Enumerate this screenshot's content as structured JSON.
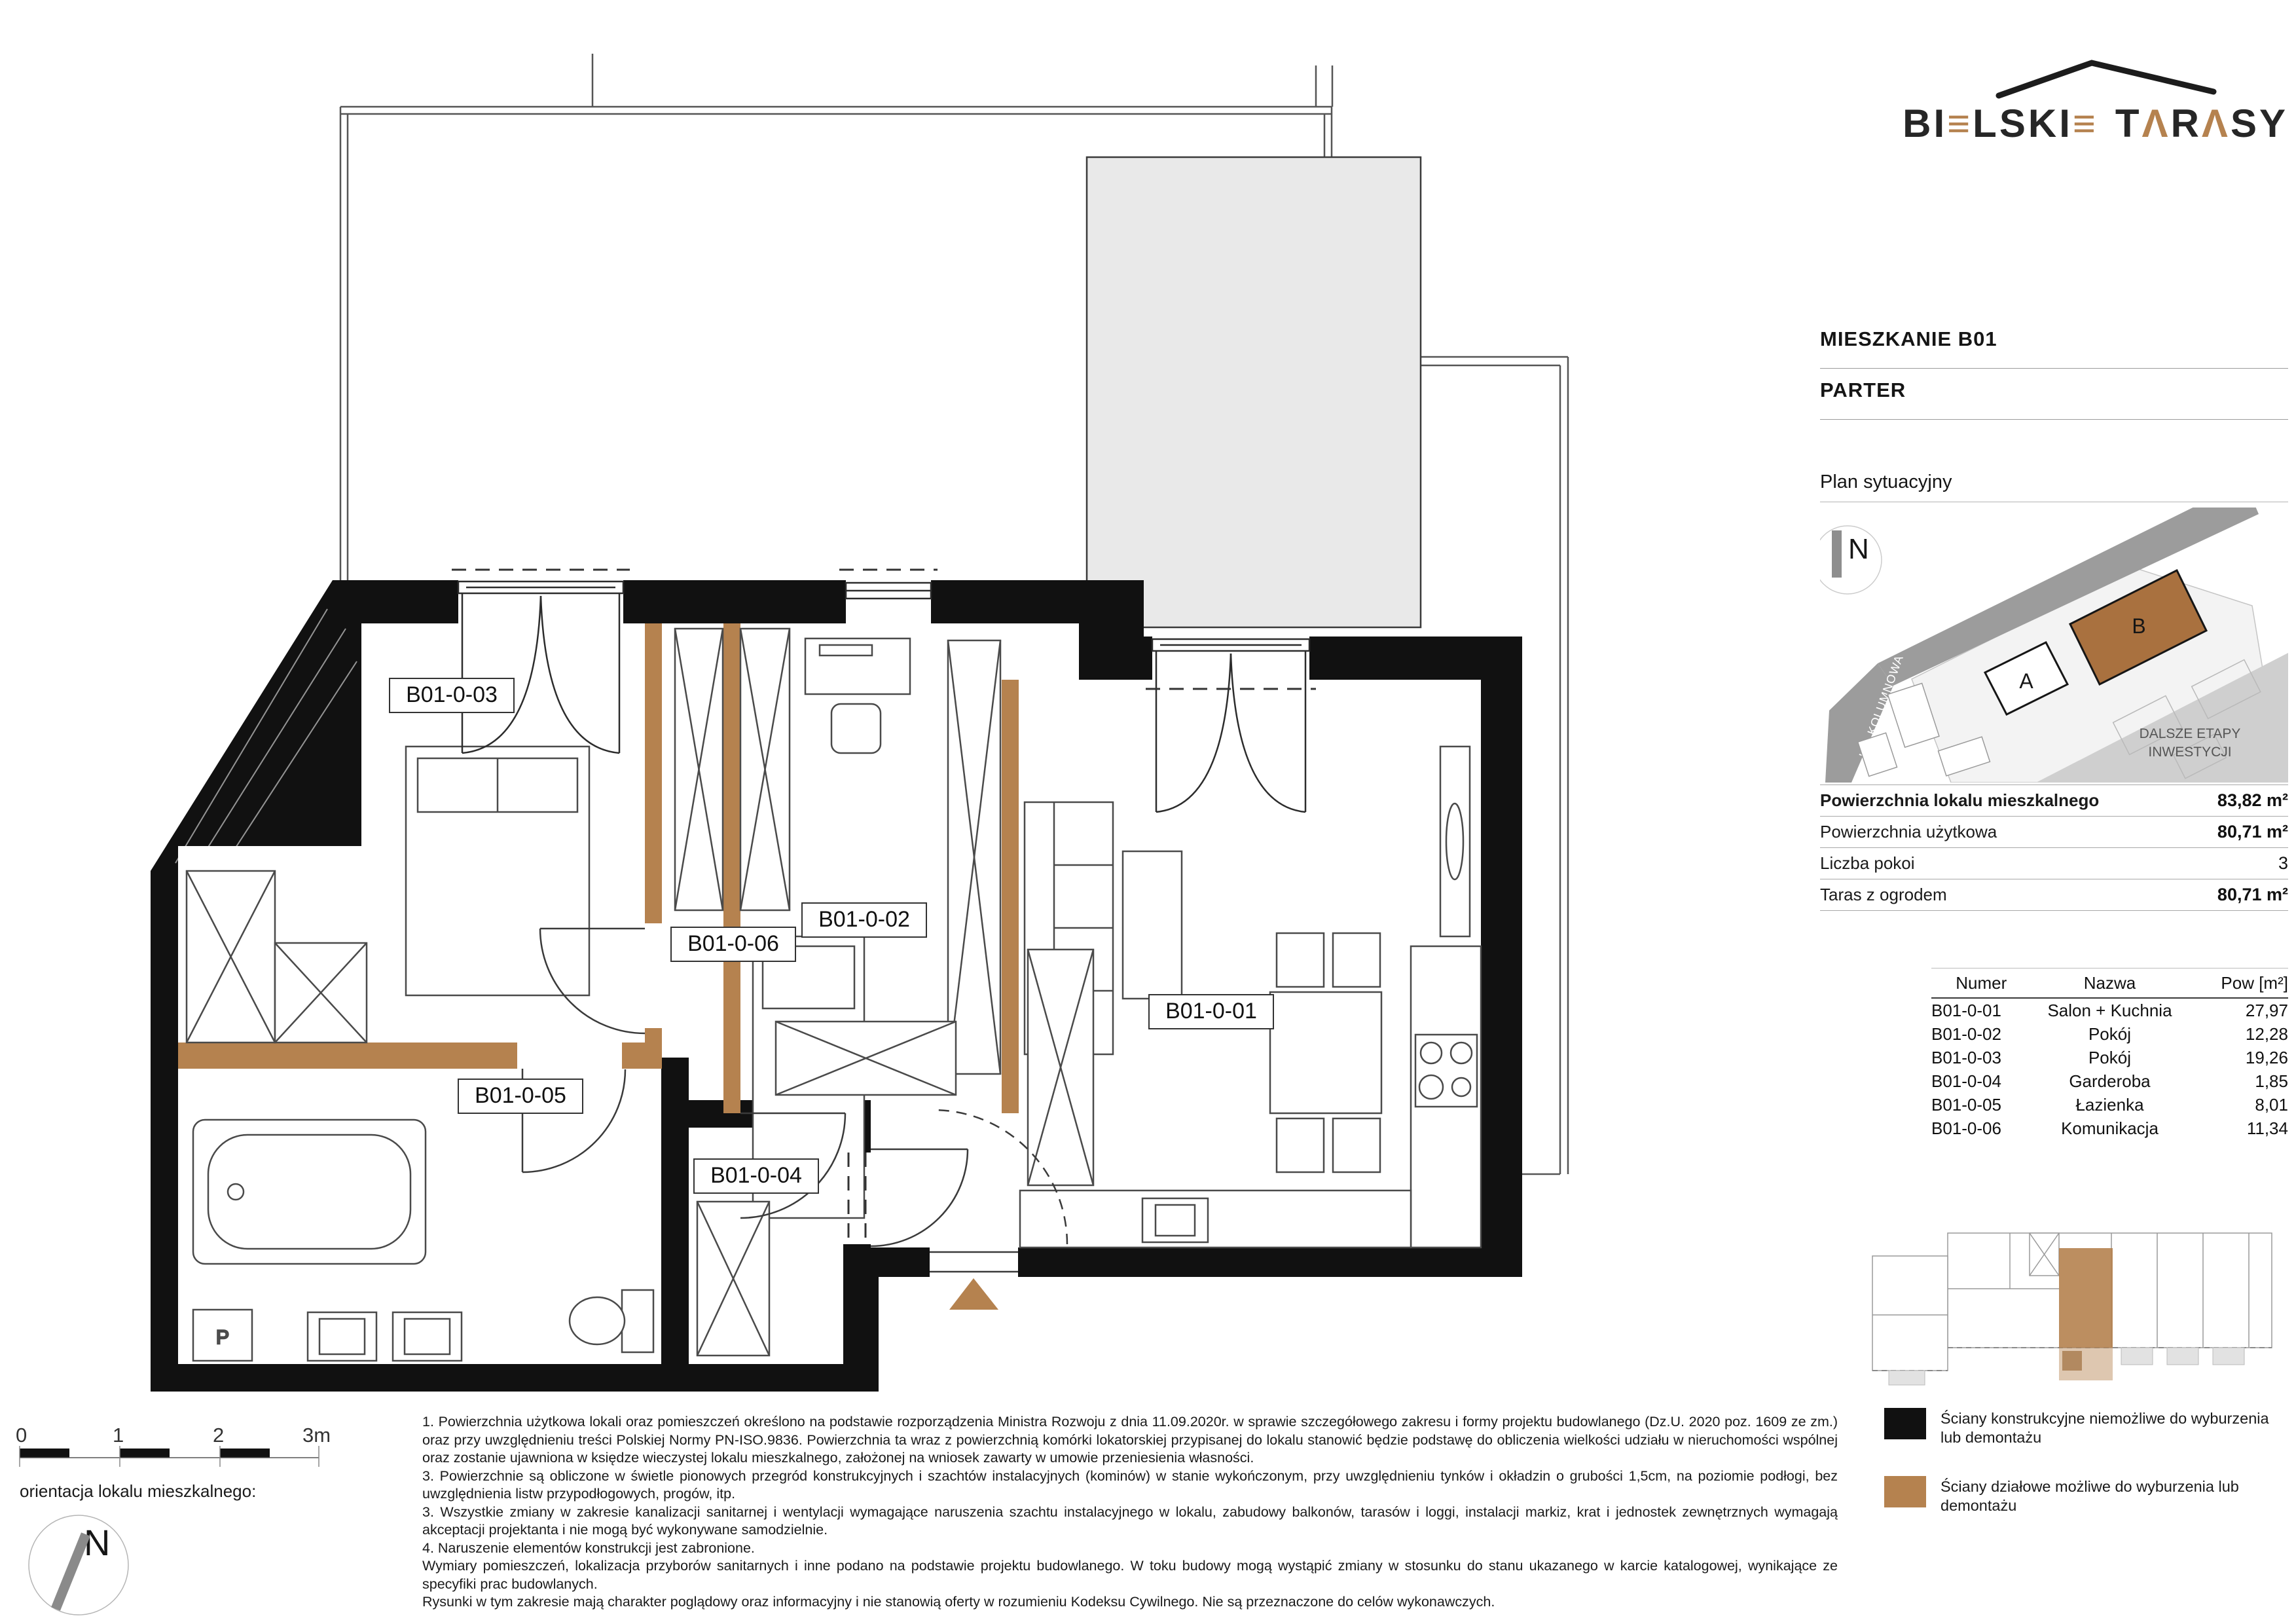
{
  "brand": {
    "word1": [
      "B",
      "I",
      "≡",
      "L",
      "S",
      "K",
      "I",
      "≡"
    ],
    "word2": [
      "T",
      "Λ",
      "R",
      "Λ",
      "S",
      "Y"
    ],
    "accent_color": "#b5824f",
    "dark_color": "#262626"
  },
  "header": {
    "title": "MIESZKANIE B01",
    "subtitle": "PARTER"
  },
  "sitplan": {
    "title": "Plan sytuacyjny",
    "north": "N",
    "street_filarowa": "UL. FILAROWA",
    "street_kolumnowa": "UL. KOLUMNOWA",
    "building_a": "A",
    "building_b": "B",
    "future_line1": "DALSZE ETAPY",
    "future_line2": "INWESTYCJI"
  },
  "summary": {
    "rows": [
      {
        "label": "Powierzchnia lokalu mieszkalnego",
        "value": "83,82 m²"
      },
      {
        "label": "Powierzchnia użytkowa",
        "value": "80,71 m²"
      },
      {
        "label": "Liczba pokoi",
        "value": "3"
      },
      {
        "label": "Taras z ogrodem",
        "value": "80,71 m²"
      }
    ]
  },
  "rooms": {
    "headers": [
      "Numer",
      "Nazwa",
      "Pow [m²]"
    ],
    "rows": [
      {
        "num": "B01-0-01",
        "name": "Salon + Kuchnia",
        "area": "27,97"
      },
      {
        "num": "B01-0-02",
        "name": "Pokój",
        "area": "12,28"
      },
      {
        "num": "B01-0-03",
        "name": "Pokój",
        "area": "19,26"
      },
      {
        "num": "B01-0-04",
        "name": "Garderoba",
        "area": "1,85"
      },
      {
        "num": "B01-0-05",
        "name": "Łazienka",
        "area": "8,01"
      },
      {
        "num": "B01-0-06",
        "name": "Komunikacja",
        "area": "11,34"
      }
    ]
  },
  "plan": {
    "room_ids": [
      "B01-0-01",
      "B01-0-02",
      "B01-0-03",
      "B01-0-04",
      "B01-0-05",
      "B01-0-06"
    ],
    "washer_label": "P",
    "wall_color": "#111111",
    "partition_color": "#b5824f",
    "terrace_fill": "#e9e9e9"
  },
  "legend": {
    "items": [
      {
        "color": "#111111",
        "label": "Ściany konstrukcyjne niemożliwe do wyburzenia lub demontażu"
      },
      {
        "color": "#b5824f",
        "label": "Ściany działowe możliwe do wyburzenia lub demontażu"
      }
    ]
  },
  "scalebar": {
    "ticks": [
      "0",
      "1",
      "2",
      "3m"
    ]
  },
  "orientation": {
    "caption": "orientacja lokalu mieszkalnego:",
    "north": "N"
  },
  "footnotes": {
    "paragraphs": [
      "1. Powierzchnia użytkowa lokali oraz pomieszczeń określono na podstawie rozporządzenia Ministra Rozwoju z dnia 11.09.2020r. w sprawie szczegółowego zakresu i formy projektu budowlanego (Dz.U. 2020 poz. 1609 ze zm.) oraz przy uwzględnieniu treści Polskiej Normy PN-ISO.9836. Powierzchnia ta wraz z powierzchnią komórki lokatorskiej przypisanej do lokalu stanowić będzie podstawę do obliczenia wielkości udziału w nieruchomości wspólnej oraz zostanie ujawniona w księdze wieczystej lokalu mieszkalnego, założonej na wniosek zawarty w umowie przeniesienia własności.",
      "3. Powierzchnie są obliczone w świetle pionowych przegród konstrukcyjnych i szachtów instalacyjnych (kominów) w stanie wykończonym, przy uwzględnieniu tynków i okładzin o grubości 1,5cm, na poziomie podłogi, bez uwzględnienia listw przypodłogowych, progów, itp.",
      "3. Wszystkie zmiany w zakresie kanalizacji sanitarnej i wentylacji wymagające naruszenia szachtu instalacyjnego w lokalu, zabudowy balkonów, tarasów i loggi, instalacji markiz, krat i jednostek zewnętrznych wymagają akceptacji projektanta i nie mogą być wykonywane samodzielnie.",
      "4. Naruszenie elementów konstrukcji jest zabronione.",
      "Wymiary pomieszczeń, lokalizacja przyborów sanitarnych i inne podano na podstawie projektu budowlanego. W toku budowy mogą wystąpić zmiany w stosunku do stanu ukazanego w karcie katalogowej, wynikające ze specyfiki prac budowlanych.",
      "Rysunki w tym zakresie mają charakter poglądowy oraz informacyjny i nie stanowią oferty w rozumieniu Kodeksu Cywilnego. Nie są przeznaczone do celów wykonawczych."
    ]
  }
}
